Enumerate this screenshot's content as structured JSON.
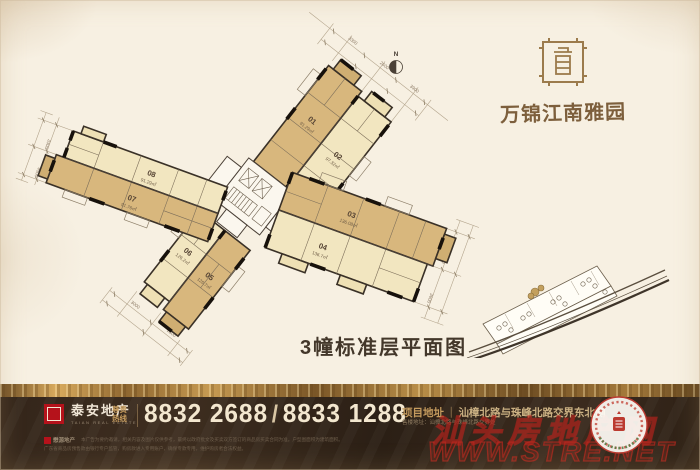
{
  "brand": {
    "name": "万锦江南雅园"
  },
  "plan": {
    "caption": "3幢标准层平面图",
    "north_label": "N",
    "units": [
      {
        "no": "01",
        "area": "91.29㎡"
      },
      {
        "no": "02",
        "area": "97.32㎡"
      },
      {
        "no": "03",
        "area": "136.08㎡"
      },
      {
        "no": "04",
        "area": "136.7㎡"
      },
      {
        "no": "05",
        "area": "126.7㎡"
      },
      {
        "no": "06",
        "area": "126.2㎡"
      },
      {
        "no": "07",
        "area": "91.76㎡"
      },
      {
        "no": "08",
        "area": "91.29㎡"
      }
    ],
    "dims": {
      "top": [
        "3300",
        "2600",
        "3900"
      ],
      "bottom": [
        "3000",
        "2800"
      ],
      "right": [
        "4200",
        "3600"
      ],
      "left": [
        "3300",
        "4500"
      ]
    }
  },
  "footer": {
    "developer": "泰安地产",
    "developer_sub": "TAIAN REAL ESTATE",
    "partner": "懋源地产",
    "hotline_label_1": "尊贵",
    "hotline_label_2": "热线",
    "phone1": "8832 2688",
    "phone_sep": "/",
    "phone2": "8833 1288",
    "address_label": "项目地址",
    "address_sep": "｜",
    "address": "汕樟北路与珠峰北路交界东北侧",
    "address_sub": "售楼地址：汕樟北路与珠峰北路交界处",
    "disclaimer1": "本广告为要约邀请，相关内容及图片仅供参考，最终以政府批文及买卖双方签订的商品房买卖合同为准。户型图面积为建筑面积。",
    "disclaimer2": "广东省商品房预售款由银行专户监管，购房款进入专用账户，确保专款专用，维护购房者合法权益。"
  },
  "watermark": {
    "site": "汕头房地产网",
    "url": "WWW.STRE.NET"
  },
  "colors": {
    "tan": "#d8b77d",
    "pale": "#f2e6c0",
    "footer_bg": "#34261a",
    "gold": "#c89850",
    "brand_red": "#b5121b",
    "watermark_red": "#c0231e"
  }
}
